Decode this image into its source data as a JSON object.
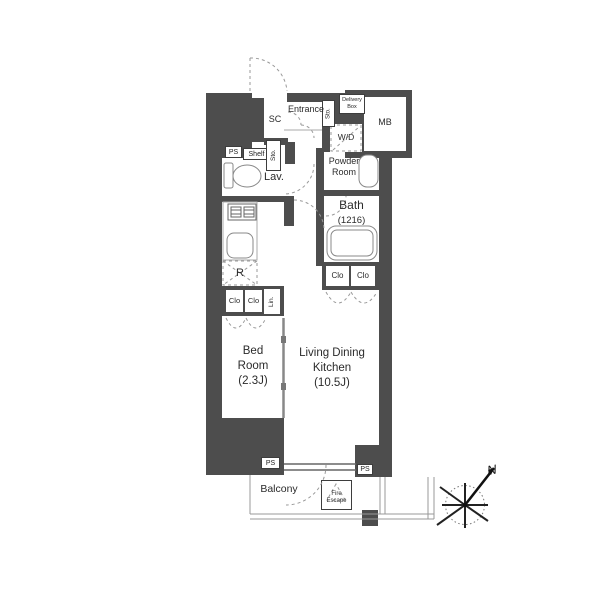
{
  "labels": {
    "sc": "SC",
    "entrance": "Entrance",
    "sto": "Sto.",
    "delivery_box": [
      "Delivery",
      "Box"
    ],
    "mb": "MB",
    "wd": "W/D",
    "powder_room": [
      "Powder",
      "Room"
    ],
    "bath": "Bath",
    "bath_size": "(1216)",
    "ps": "PS",
    "shelf": "Shelf",
    "lav": "Lav.",
    "r": "R",
    "clo": "Clo",
    "lin": "Lin.",
    "bed_room": [
      "Bed",
      "Room",
      "(2.3J)"
    ],
    "ldk": [
      "Living Dining",
      "Kitchen",
      "(10.5J)"
    ],
    "balcony": "Balcony",
    "fire_escape": [
      "Fire",
      "Escape"
    ],
    "north": "N"
  },
  "colors": {
    "background": "#ffffff",
    "wall": "#4d4d4d",
    "text": "#333333",
    "line": "#888888"
  }
}
